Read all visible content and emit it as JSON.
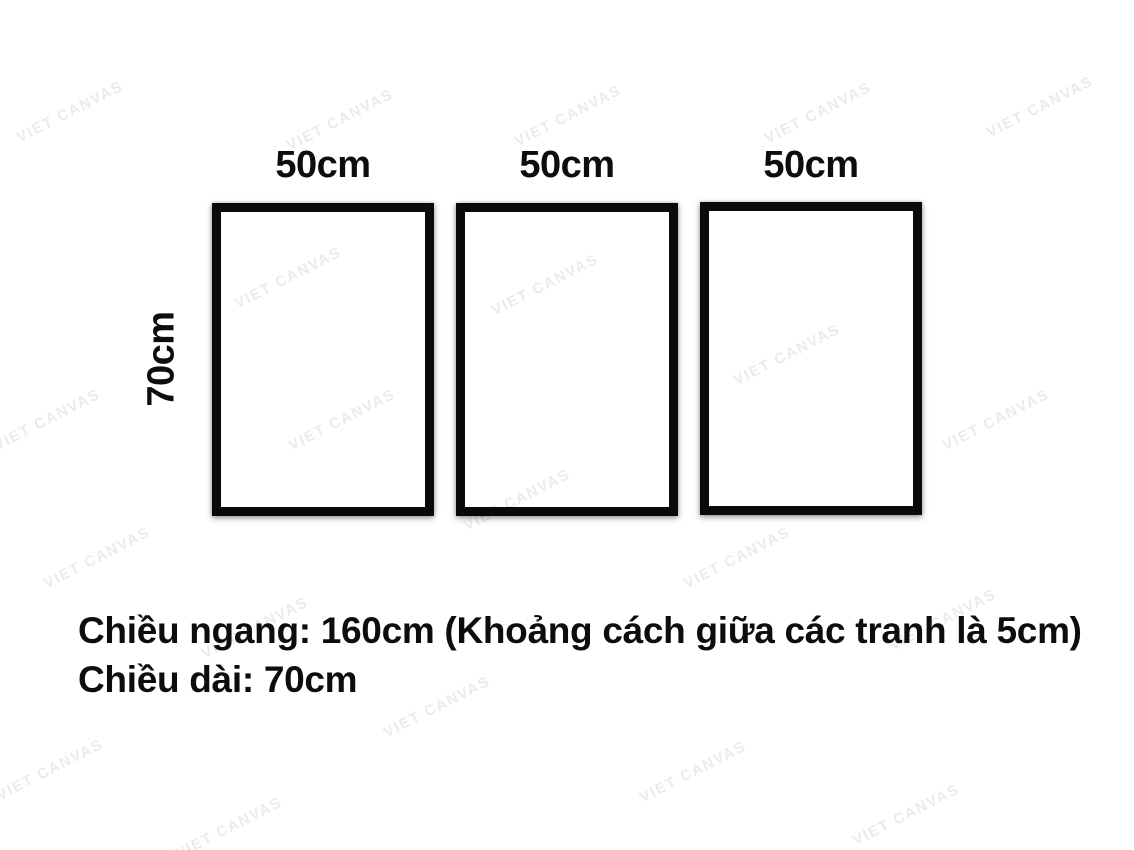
{
  "watermark": {
    "text": "VIET CANVAS",
    "color": "#ebebeb"
  },
  "frames": [
    {
      "width_label": "50cm"
    },
    {
      "width_label": "50cm"
    },
    {
      "width_label": "50cm"
    }
  ],
  "height_label": "70cm",
  "caption": {
    "line1": "Chiều ngang: 160cm (Khoảng cách giữa các tranh là 5cm)",
    "line2": "Chiều dài: 70cm"
  },
  "colors": {
    "background": "#ffffff",
    "frame_border": "#0a0a0a",
    "text": "#0d0d0d",
    "watermark": "#ebebeb"
  }
}
